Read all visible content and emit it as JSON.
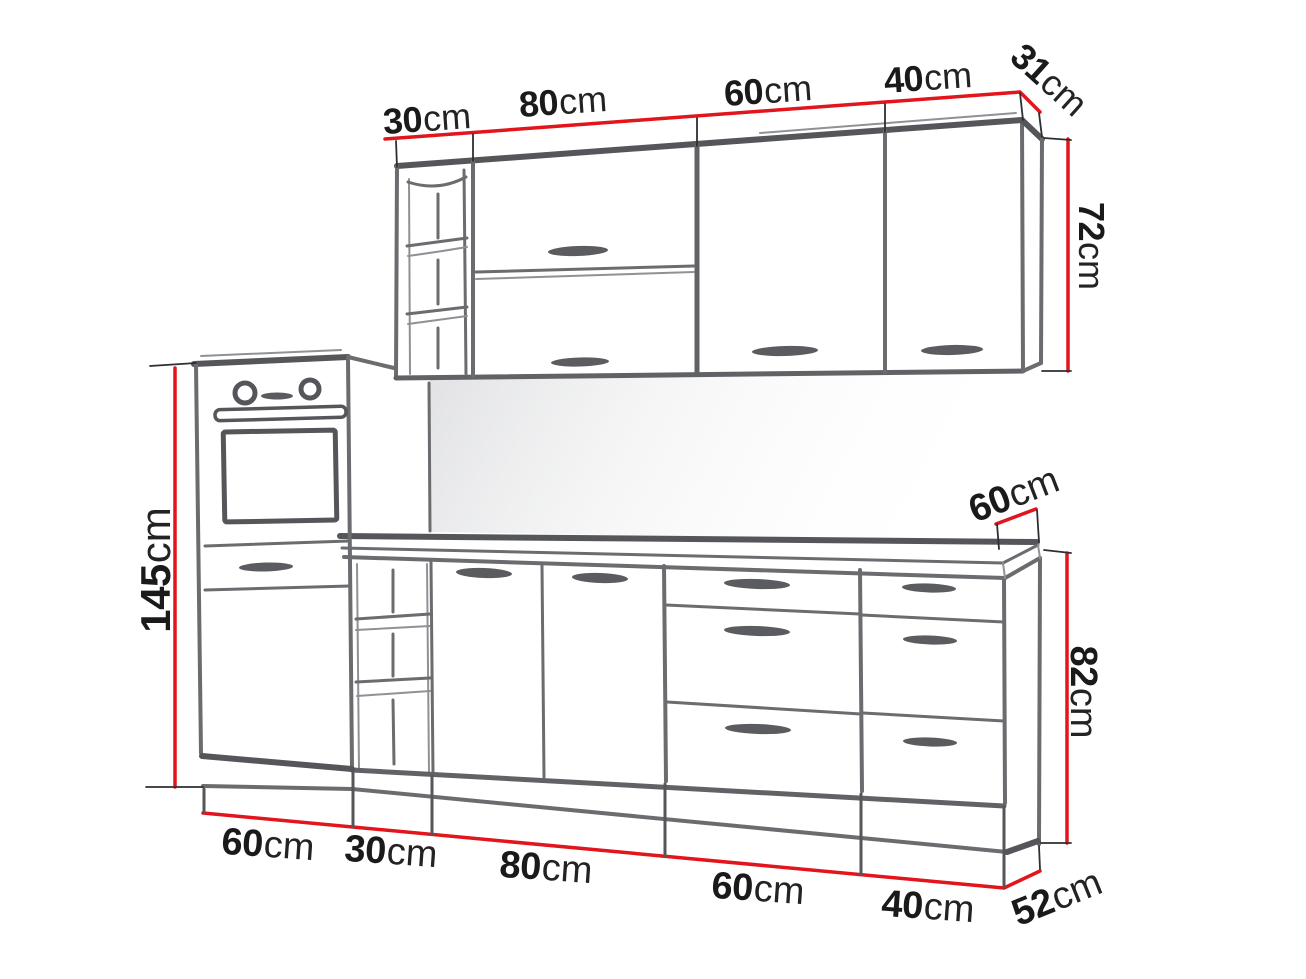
{
  "palette": {
    "background": "#ffffff",
    "dimension_red": "#e2151c",
    "line_gray": "#6b6c6f",
    "line_gray_dark": "#55565a",
    "label_black": "#1a1a1a",
    "backsplash_gray": "#d9dadc"
  },
  "wall_units": {
    "width_labels": [
      {
        "value": "30",
        "unit": "cm"
      },
      {
        "value": "80",
        "unit": "cm"
      },
      {
        "value": "60",
        "unit": "cm"
      },
      {
        "value": "40",
        "unit": "cm"
      }
    ],
    "depth_label": {
      "value": "31",
      "unit": "cm"
    },
    "height_label": {
      "value": "72",
      "unit": "cm"
    }
  },
  "tall_unit": {
    "height_label": {
      "value": "145",
      "unit": "cm"
    }
  },
  "base_units": {
    "worktop_depth_label": {
      "value": "60",
      "unit": "cm"
    },
    "height_label": {
      "value": "82",
      "unit": "cm"
    },
    "width_labels": [
      {
        "value": "60",
        "unit": "cm"
      },
      {
        "value": "30",
        "unit": "cm"
      },
      {
        "value": "80",
        "unit": "cm"
      },
      {
        "value": "60",
        "unit": "cm"
      },
      {
        "value": "40",
        "unit": "cm"
      }
    ],
    "depth_label": {
      "value": "52",
      "unit": "cm"
    }
  }
}
